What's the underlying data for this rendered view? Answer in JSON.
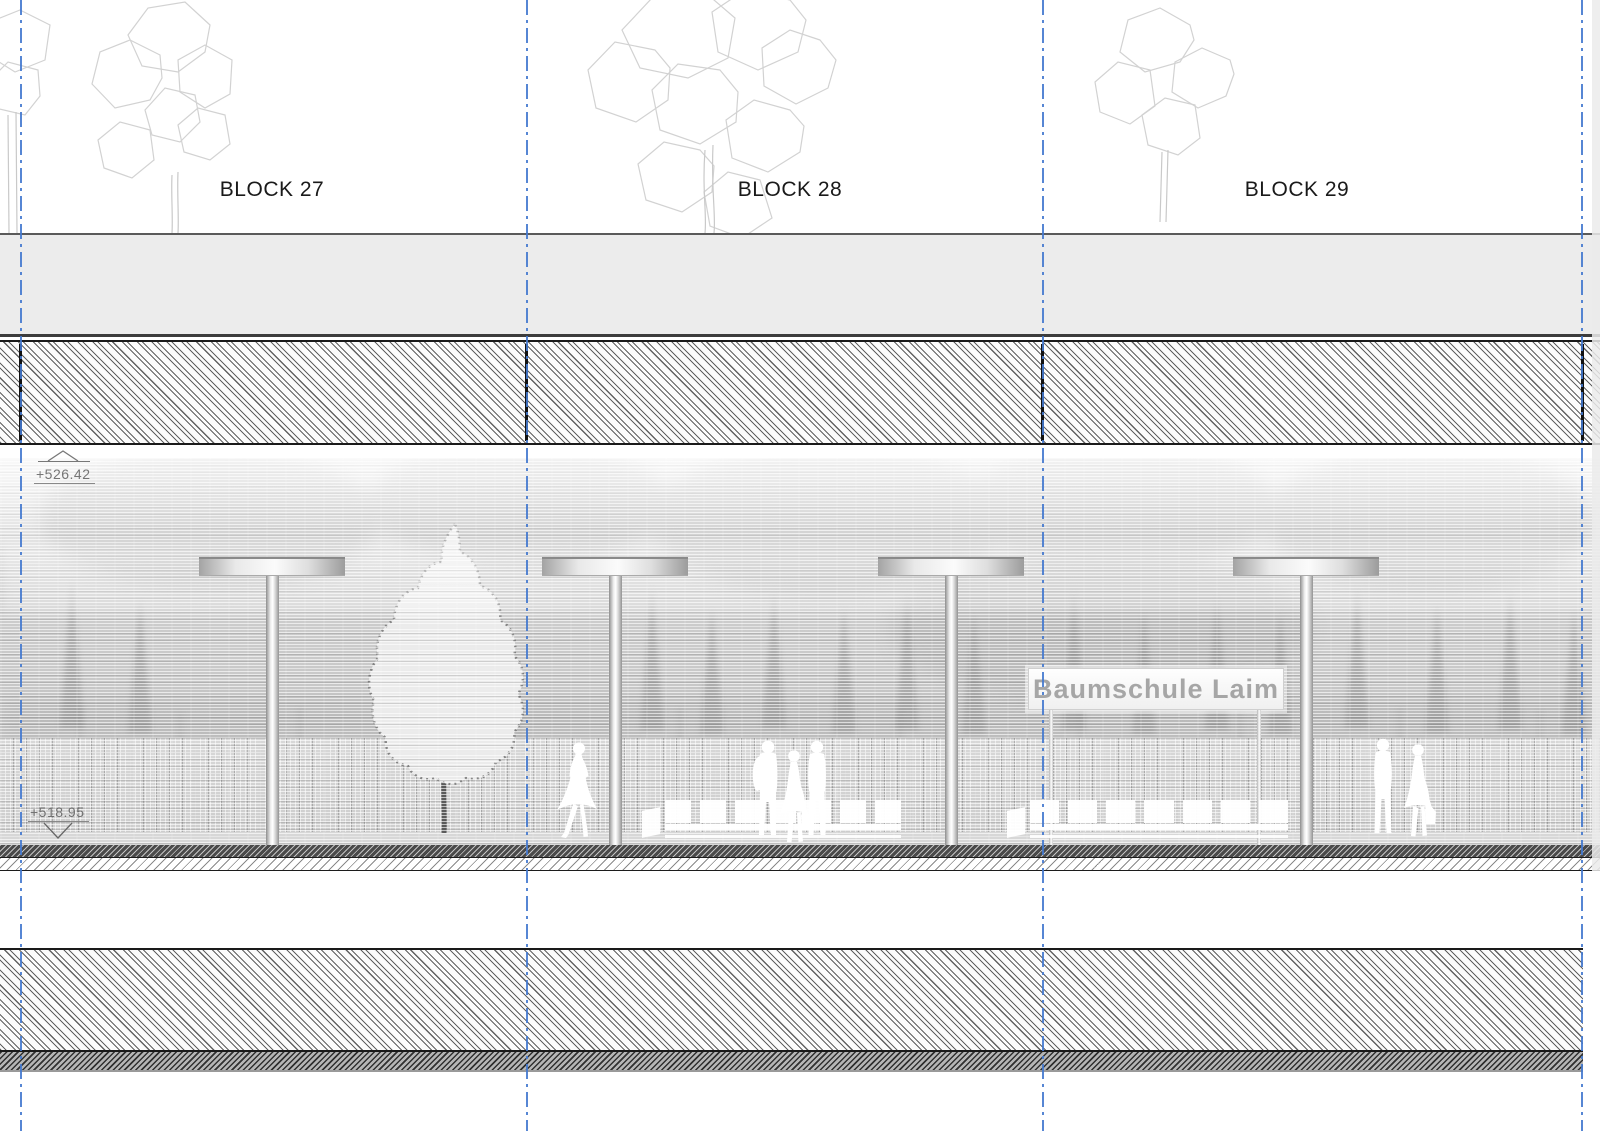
{
  "title": "Baumschule Laim platform elevation drawing",
  "blocks": [
    {
      "label": "BLOCK 27"
    },
    {
      "label": "BLOCK 28"
    },
    {
      "label": "BLOCK 29"
    }
  ],
  "elevation_markers": {
    "upper": "+526.42",
    "platform": "+518.95"
  },
  "station_sign": {
    "label": "Baumschule Laim"
  },
  "colors": {
    "gridline": "#4479cf",
    "sign_text": "#a6a6a6",
    "block_label": "#1a1a1a",
    "elevation_text": "#5f5f5f",
    "hatch_line": "#464646"
  }
}
